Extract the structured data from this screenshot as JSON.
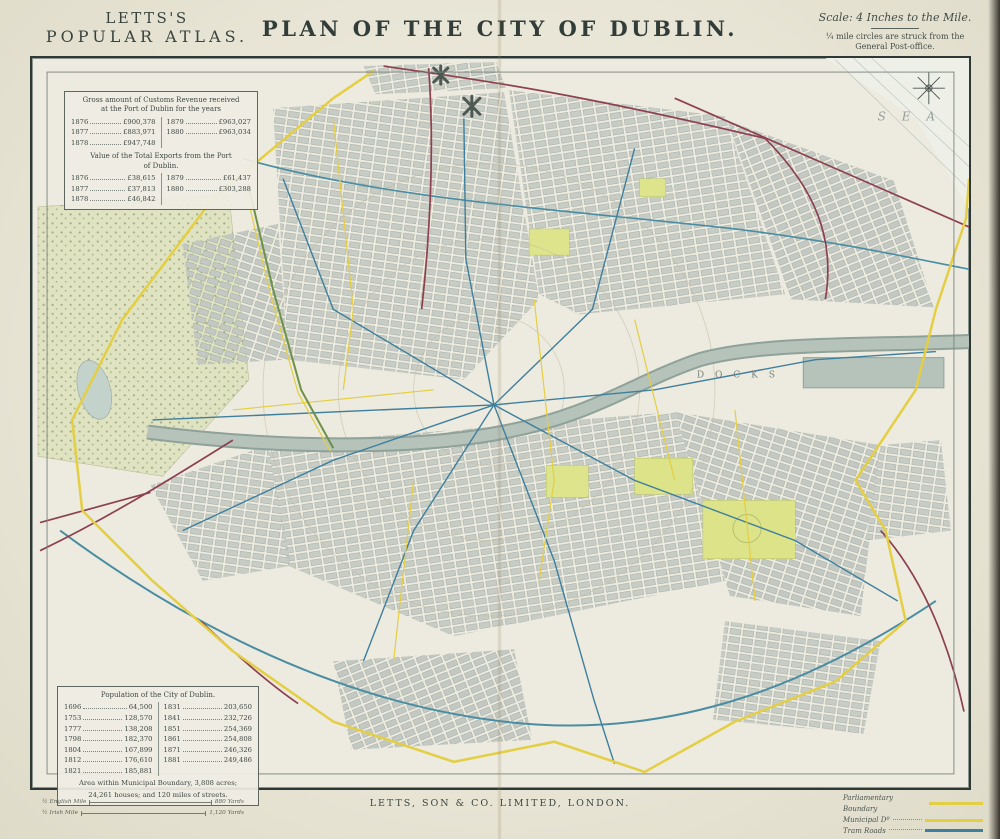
{
  "atlas": {
    "line1": "LETTS'S",
    "line2": "POPULAR ATLAS."
  },
  "title": "PLAN OF THE CITY OF DUBLIN.",
  "scale_block": {
    "scale_note": "Scale: 4 Inches to the Mile.",
    "circles_note_1": "¼ mile circles are struck from the",
    "circles_note_2": "General Post-office."
  },
  "customs_box": {
    "title1": "Gross amount of Customs Revenue received",
    "title2": "at the Port of Dublin for the years",
    "left_rows": [
      [
        "1876",
        "£900,378"
      ],
      [
        "1877",
        "£883,971"
      ],
      [
        "1878",
        "£947,748"
      ]
    ],
    "right_rows": [
      [
        "1879",
        "£963,027"
      ],
      [
        "1880",
        "£963,034"
      ]
    ],
    "exports_title1": "Value of the Total Exports from the Port",
    "exports_title2": "of Dublin.",
    "exports_left_rows": [
      [
        "1876",
        "£38,615"
      ],
      [
        "1877",
        "£37,813"
      ],
      [
        "1878",
        "£46,842"
      ]
    ],
    "exports_right_rows": [
      [
        "1879",
        "£61,437"
      ],
      [
        "1880",
        "£303,288"
      ]
    ]
  },
  "population_box": {
    "title": "Population of the City of Dublin.",
    "left_rows": [
      [
        "1696",
        "64,500"
      ],
      [
        "1753",
        "128,570"
      ],
      [
        "1777",
        "138,208"
      ],
      [
        "1798",
        "182,370"
      ],
      [
        "1804",
        "167,899"
      ],
      [
        "1812",
        "176,610"
      ],
      [
        "1821",
        "185,881"
      ]
    ],
    "right_rows": [
      [
        "1831",
        "203,650"
      ],
      [
        "1841",
        "232,726"
      ],
      [
        "1851",
        "254,369"
      ],
      [
        "1861",
        "254,808"
      ],
      [
        "1871",
        "246,326"
      ],
      [
        "1881",
        "249,486"
      ]
    ],
    "area_line_1": "Area within Municipal Boundary, 3,808 acres;",
    "area_line_2": "24,261 houses; and 120 miles of streets."
  },
  "map_labels": {
    "sea": "S E A",
    "docks": "D O C K S"
  },
  "legend": {
    "items": [
      {
        "label": "Parliamentary Boundary",
        "color": "#e4ce44"
      },
      {
        "label": "Municipal Dº",
        "color": "#e4ce44"
      },
      {
        "label": "Tram Roads",
        "color": "#3f7f9e"
      }
    ]
  },
  "scale_bars": [
    {
      "label": "½ English Mile",
      "end": "880 Yards"
    },
    {
      "label": "½ Irish Mile",
      "end": "1,120 Yards"
    }
  ],
  "imprint": "LETTS, SON & CO. LIMITED, LONDON.",
  "colors": {
    "paper": "#e9e6d8",
    "frame": "#2e3936",
    "boundary_yellow": "#e4ce44",
    "tram_blue": "#3f7f9e",
    "railway_maroon": "#8d4150",
    "park_green": "#e0e3c2",
    "bright_park": "#dde48c",
    "river": "#b5c3bb"
  }
}
